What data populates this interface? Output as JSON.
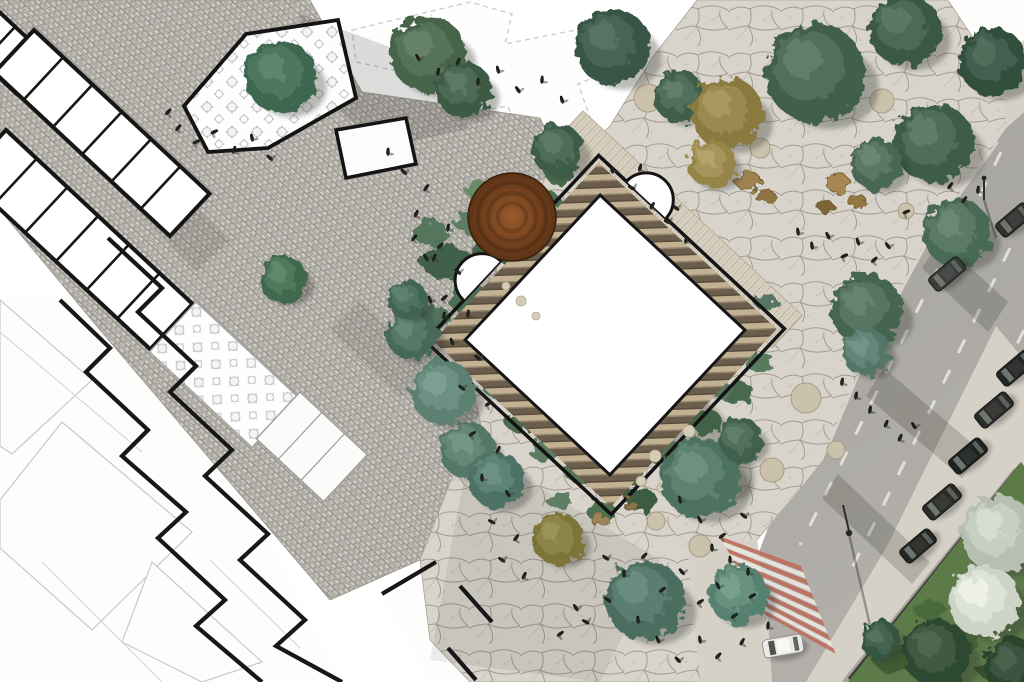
{
  "meta": {
    "kind": "landscape-site-plan-rendering",
    "canvas_w": 1024,
    "canvas_h": 682
  },
  "palette": {
    "paper": "#ffffff",
    "street_joint": "#8f8b85",
    "street_stone_a": "#d0cdc7",
    "street_stone_b": "#c2bfb9",
    "plaza_bg": "#d8d4cc",
    "plaza_crack": "#a39c8f",
    "plaza_crack_lt": "#beb8ab",
    "road_a": "#a5a3a0",
    "road_b": "#b3b0aa",
    "lane_dash": "#e7e4dd",
    "curb": "#d9d6cf",
    "sidewalk": "#d5d1c7",
    "wall": "#403f39",
    "grass": "#5d7a49",
    "crosswalk_red": "#bd6e5e",
    "crosswalk_white": "#e9e6df",
    "building_stroke": "#161616",
    "faint_stroke": "#cdcdca",
    "deck": "#d7cfc0",
    "deck_line": "#a59b87",
    "scallop_light": "#c3b193",
    "scallop_dark": "#6b5d4b",
    "scallop_mid": "#93836b",
    "rust_hi": "#9a5a2c",
    "rust_lo": "#5c3316",
    "stone_seat": "#cbc2ac",
    "stone_seat_edge": "#a79d85",
    "person": "#20231e",
    "person_shadow": "#41443c",
    "shadow": "#26281f"
  },
  "scene": {
    "faint": {
      "white_fills": [
        "108,238 342,682 262,682 60,300",
        "60,300 262,682 0,682 0,300",
        "382,594 436,562 500,640 480,682 430,682"
      ],
      "dashed_poly": "352,30 470,2 512,14 505,44 596,26 612,70 578,84 594,128 520,146 508,106 432,120 420,76 356,62",
      "polys": [
        "0,300 92,380 12,454 0,446",
        "62,422 192,532 92,630 0,548 0,500",
        "152,562 262,662 202,682 122,642"
      ],
      "lines": [
        [
          0,
          332,
          142,
          452
        ],
        [
          42,
          562,
          162,
          682
        ],
        [
          210,
          560,
          300,
          648
        ],
        [
          612,
          10,
          680,
          95
        ]
      ]
    },
    "street": {
      "poly": "40,0 310,0 362,92 540,118 565,168 480,210 515,335 468,360 485,445 455,470 420,560 330,600 100,330 0,210 0,0",
      "shadows": [
        {
          "pts": "300,14 420,58 470,128 382,148 302,78",
          "o": 0.16
        },
        {
          "pts": "140,150 230,240 196,272 108,180",
          "o": 0.12
        },
        {
          "pts": "360,300 430,370 400,398 330,330",
          "o": 0.1
        }
      ]
    },
    "plaza": {
      "poly": "652,58 697,0 948,0 1012,96 1006,132 937,228 868,352 823,462 757,540 742,566 738,682 470,682 430,640 420,560 455,470 485,445 468,360 515,335 480,210 565,168 610,126",
      "white_wedge": "948,0 1024,0 1024,34 1002,58",
      "shades": [
        {
          "pts": "470,445 660,560 600,682 430,660",
          "o": 0.07
        }
      ]
    },
    "road": {
      "poly": "1006,128 1024,112 1024,520 905,682 756,682 750,620 756,560 768,528 823,460 868,352 937,228",
      "dashes": [
        "968,208 900,345 838,470 800,545",
        "1010,248 940,390 876,520 846,580",
        "1024,330 965,450 918,548",
        "1001,152 972,212"
      ],
      "edge_line": "998,142 935,228 868,352 826,452",
      "sidewalks": [
        "1024,360 1024,682 806,682 886,548 996,326",
        "688,556 757,538 768,614 772,682 700,682",
        "1003,58 1024,40 1024,112 1006,128"
      ],
      "wall": {
        "x1": 1021,
        "y1": 464,
        "x2": 849,
        "y2": 679
      },
      "grass_poly": "1021,462 1024,466 1024,682 848,682",
      "grass_blobs": [
        [
          900,
          660,
          26,
          14,
          "#3f5c33"
        ],
        [
          960,
          640,
          20,
          12,
          "#46643a"
        ],
        [
          1000,
          670,
          22,
          12,
          "#37512e"
        ],
        [
          930,
          610,
          16,
          10,
          "#4a6a3e"
        ]
      ],
      "shadows": [
        "940,240 1008,302 988,332 922,268",
        "884,368 982,452 962,478 866,396",
        "838,474 930,562 912,584 822,498"
      ],
      "crosswalk": {
        "a1": [
          719,
          536
        ],
        "a2": [
          766,
          616
        ],
        "b1": [
          801,
          566
        ],
        "b2": [
          836,
          655
        ],
        "n": 13
      },
      "poles": [
        {
          "line": [
            849,
            531,
            843,
            505
          ],
          "head": [
            849,
            533,
            3.2
          ],
          "shadow": [
            849,
            534,
            872,
            634
          ]
        },
        {
          "line": [
            984,
            178,
            984,
            200
          ],
          "head": [
            984,
            178,
            2.4
          ],
          "shadow": [
            984,
            200,
            996,
            238
          ]
        }
      ]
    },
    "buildings": {
      "rows": [
        {
          "t": [
            -20,
            -6
          ],
          "rot": 43,
          "w": 95,
          "h": 48,
          "divs": [
            48
          ]
        },
        {
          "t": [
            34,
            30
          ],
          "rot": 43,
          "w": 240,
          "h": 58,
          "divs": [
            40,
            80,
            120,
            160,
            200
          ]
        },
        {
          "t": [
            6,
            130
          ],
          "rot": 43,
          "w": 255,
          "h": 62,
          "divs": [
            42,
            84,
            126,
            168,
            210
          ]
        }
      ],
      "table_rooms": [
        {
          "poly": "184,106 246,34 338,20 356,98 268,148 208,152",
          "stroke": "#141414",
          "sw": 3.8,
          "fill": "url(#patTables)"
        },
        {
          "t": [
            196,
            302
          ],
          "rot": 43,
          "w": 140,
          "h": 68,
          "stroke": "#a7a7a5",
          "sw": 1.4,
          "fill": "url(#patTables)"
        },
        {
          "t": [
            300,
            392
          ],
          "rot": 43,
          "w": 92,
          "h": 64,
          "stroke": "#9c9c9a",
          "sw": 1.4,
          "fill": "#fbfbfa",
          "divs": [
            30,
            61
          ]
        }
      ],
      "block": {
        "poly": "336,130 406,118 416,164 346,178",
        "stroke": "#141414",
        "sw": 3.5,
        "fill": "#fcfcfc"
      },
      "zigzags": [
        "M108,238 L162,288 L138,312 L196,366 L170,392 L232,450 L205,476 L268,534 L240,560 L305,620 L276,646 L342,682",
        "M60,300 L110,348 L86,372 L148,430 L122,456 L186,512 L158,538 L225,600 L196,626 L262,682",
        "M382,594 L436,562",
        "M460,586 L492,622",
        "M448,648 L476,680"
      ]
    },
    "pavilion": {
      "cx": 605,
      "cy": 335,
      "rot": 43,
      "deck": [
        436,
        186,
        300,
        44
      ],
      "outer": [
        478,
        208,
        254,
        254
      ],
      "band": [
        494,
        224,
        222,
        222
      ],
      "band_w": 21,
      "inner": [
        506,
        236,
        198,
        198
      ],
      "arcs": [
        "M516,208 A27,27 0 0 1 570,208",
        "M478,352 A27,27 0 0 0 478,406"
      ],
      "under_shadow": {
        "cx": 680,
        "cy": 430,
        "rx": 95,
        "ry": 40
      }
    },
    "rust_circle": {
      "cx": 512,
      "cy": 217,
      "r": 44
    },
    "garden_blobs": [
      [
        447,
        262,
        26,
        17,
        "#3f6149"
      ],
      [
        469,
        299,
        21,
        15,
        "#4a6e54"
      ],
      [
        431,
        233,
        17,
        13,
        "#55755c"
      ],
      [
        491,
        251,
        19,
        13,
        "#43634b"
      ],
      [
        543,
        201,
        17,
        11,
        "#4c6d52"
      ],
      [
        470,
        223,
        15,
        11,
        "#5c7d63"
      ],
      [
        499,
        299,
        17,
        11,
        "#57806b"
      ],
      [
        432,
        318,
        19,
        13,
        "#507258"
      ],
      [
        560,
        176,
        14,
        9,
        "#48684e"
      ],
      [
        588,
        190,
        13,
        8,
        "#3f5c46"
      ],
      [
        478,
        190,
        13,
        9,
        "#6b8b6b"
      ],
      [
        516,
        262,
        14,
        9,
        "#35573f"
      ],
      [
        744,
        330,
        19,
        13,
        "#4b6b51"
      ],
      [
        760,
        362,
        15,
        10,
        "#5a7a60"
      ],
      [
        737,
        392,
        17,
        11,
        "#49694f"
      ],
      [
        764,
        300,
        12,
        8,
        "#567564"
      ],
      [
        701,
        421,
        21,
        13,
        "#426247"
      ],
      [
        662,
        451,
        19,
        12,
        "#507053"
      ],
      [
        622,
        472,
        21,
        13,
        "#45654a"
      ],
      [
        582,
        471,
        19,
        12,
        "#527257"
      ],
      [
        546,
        451,
        17,
        11,
        "#5b7b60"
      ],
      [
        521,
        421,
        17,
        11,
        "#4b6b50"
      ],
      [
        501,
        391,
        15,
        10,
        "#567666"
      ],
      [
        641,
        500,
        17,
        11,
        "#3d5d42"
      ],
      [
        601,
        511,
        15,
        10,
        "#507050"
      ],
      [
        560,
        500,
        14,
        9,
        "#5e7e63"
      ],
      [
        472,
        346,
        17,
        11,
        "#486850"
      ],
      [
        694,
        455,
        14,
        9,
        "#6f8f5e"
      ],
      [
        720,
        390,
        13,
        9,
        "#587860"
      ],
      [
        652,
        435,
        10,
        6,
        "#8aa878"
      ],
      [
        608,
        455,
        9,
        5,
        "#93ad7f"
      ],
      [
        532,
        390,
        9,
        5,
        "#7fa06f"
      ],
      [
        488,
        300,
        8,
        5,
        "#96ae82"
      ],
      [
        705,
        365,
        8,
        5,
        "#88a476"
      ]
    ],
    "rocks": [
      [
        748,
        181,
        13,
        9,
        "#a08350"
      ],
      [
        766,
        197,
        10,
        7,
        "#8f7342"
      ],
      [
        838,
        183,
        12,
        9,
        "#a5874f"
      ],
      [
        857,
        201,
        9,
        7,
        "#93763f"
      ],
      [
        826,
        207,
        8,
        6,
        "#7d6438"
      ],
      [
        600,
        520,
        9,
        6,
        "#9b8458"
      ],
      [
        630,
        505,
        7,
        5,
        "#8a7348"
      ]
    ],
    "stones": [
      [
        648,
        98,
        14
      ],
      [
        760,
        148,
        10
      ],
      [
        882,
        101,
        12
      ],
      [
        941,
        138,
        12
      ],
      [
        806,
        398,
        15
      ],
      [
        772,
        470,
        12
      ],
      [
        700,
        546,
        11
      ],
      [
        656,
        521,
        9
      ],
      [
        906,
        211,
        8
      ],
      [
        836,
        450,
        9
      ]
    ],
    "stepping_stones": [
      [
        655,
        456,
        6
      ],
      [
        671,
        470,
        5
      ],
      [
        641,
        481,
        5
      ],
      [
        521,
        301,
        5
      ],
      [
        506,
        286,
        4
      ],
      [
        536,
        316,
        4
      ],
      [
        689,
        431,
        6
      ],
      [
        662,
        488,
        5
      ]
    ],
    "trees": [
      [
        281,
        77,
        36,
        "#3e6750"
      ],
      [
        283,
        279,
        24,
        "#40684e"
      ],
      [
        412,
        334,
        26,
        "#47695a"
      ],
      [
        408,
        300,
        20,
        "#3f6352"
      ],
      [
        443,
        392,
        32,
        "#5c8173"
      ],
      [
        467,
        450,
        28,
        "#547767"
      ],
      [
        497,
        480,
        28,
        "#4e7265"
      ],
      [
        645,
        600,
        40,
        "#4b6e60"
      ],
      [
        700,
        478,
        40,
        "#4e7260"
      ],
      [
        738,
        594,
        30,
        "#57806f"
      ],
      [
        741,
        440,
        22,
        "#405f4d"
      ],
      [
        558,
        539,
        26,
        "#7d7437"
      ],
      [
        558,
        150,
        26,
        "#3c5c49"
      ],
      [
        428,
        54,
        38,
        "#466349"
      ],
      [
        464,
        90,
        28,
        "#3c5a45"
      ],
      [
        613,
        47,
        38,
        "#375444"
      ],
      [
        680,
        97,
        26,
        "#415f4c"
      ],
      [
        727,
        113,
        36,
        "#8a7a40"
      ],
      [
        712,
        164,
        24,
        "#96854a"
      ],
      [
        815,
        73,
        50,
        "#435f4b"
      ],
      [
        905,
        30,
        36,
        "#3b5947"
      ],
      [
        993,
        62,
        34,
        "#334f3e"
      ],
      [
        934,
        143,
        40,
        "#3e5d4a"
      ],
      [
        876,
        164,
        26,
        "#4a6853"
      ],
      [
        957,
        233,
        34,
        "#4a6a55"
      ],
      [
        867,
        310,
        36,
        "#45654f"
      ],
      [
        866,
        352,
        24,
        "#527668"
      ],
      [
        999,
        534,
        38,
        "#b7bfb2"
      ],
      [
        984,
        601,
        36,
        "#ced3c8"
      ],
      [
        937,
        653,
        34,
        "#2e4832"
      ],
      [
        1012,
        666,
        28,
        "#2a442e"
      ],
      [
        880,
        640,
        20,
        "#365540"
      ]
    ],
    "cars": [
      [
        947,
        274,
        -40,
        38,
        17,
        "#3a3d3a"
      ],
      [
        1014,
        220,
        -40,
        38,
        17,
        "#2f322f"
      ],
      [
        1016,
        368,
        -40,
        40,
        18,
        "#232623"
      ],
      [
        994,
        410,
        -40,
        40,
        18,
        "#2a2d2a"
      ],
      [
        968,
        456,
        -40,
        40,
        18,
        "#1f231f"
      ],
      [
        942,
        502,
        -40,
        40,
        18,
        "#2a2c28"
      ],
      [
        918,
        546,
        -40,
        38,
        17,
        "#242722"
      ],
      [
        783,
        646,
        -10,
        40,
        18,
        "#eceae6"
      ]
    ],
    "people": [
      [
        178,
        128
      ],
      [
        196,
        142
      ],
      [
        214,
        132
      ],
      [
        234,
        150
      ],
      [
        252,
        138
      ],
      [
        270,
        158
      ],
      [
        168,
        112
      ],
      [
        388,
        152
      ],
      [
        404,
        172
      ],
      [
        426,
        188
      ],
      [
        416,
        214
      ],
      [
        448,
        228
      ],
      [
        434,
        258
      ],
      [
        458,
        272
      ],
      [
        444,
        298
      ],
      [
        468,
        314
      ],
      [
        452,
        342
      ],
      [
        478,
        358
      ],
      [
        462,
        388
      ],
      [
        488,
        404
      ],
      [
        472,
        434
      ],
      [
        498,
        450
      ],
      [
        482,
        478
      ],
      [
        508,
        494
      ],
      [
        492,
        522
      ],
      [
        516,
        538
      ],
      [
        502,
        560
      ],
      [
        524,
        576
      ],
      [
        418,
        58
      ],
      [
        438,
        72
      ],
      [
        458,
        62
      ],
      [
        478,
        82
      ],
      [
        498,
        70
      ],
      [
        518,
        90
      ],
      [
        542,
        80
      ],
      [
        562,
        100
      ],
      [
        612,
        170
      ],
      [
        632,
        188
      ],
      [
        652,
        206
      ],
      [
        640,
        168
      ],
      [
        668,
        222
      ],
      [
        686,
        240
      ],
      [
        676,
        208
      ],
      [
        414,
        238
      ],
      [
        426,
        258
      ],
      [
        440,
        246
      ],
      [
        430,
        300
      ],
      [
        444,
        316
      ],
      [
        798,
        232
      ],
      [
        812,
        246
      ],
      [
        828,
        236
      ],
      [
        844,
        256
      ],
      [
        858,
        242
      ],
      [
        874,
        260
      ],
      [
        888,
        246
      ],
      [
        950,
        186
      ],
      [
        964,
        200
      ],
      [
        978,
        190
      ],
      [
        906,
        212
      ],
      [
        856,
        396
      ],
      [
        870,
        410
      ],
      [
        886,
        424
      ],
      [
        900,
        438
      ],
      [
        914,
        426
      ],
      [
        842,
        382
      ],
      [
        606,
        558
      ],
      [
        624,
        574
      ],
      [
        644,
        556
      ],
      [
        662,
        590
      ],
      [
        682,
        572
      ],
      [
        700,
        602
      ],
      [
        718,
        586
      ],
      [
        734,
        616
      ],
      [
        752,
        596
      ],
      [
        768,
        626
      ],
      [
        700,
        640
      ],
      [
        718,
        656
      ],
      [
        742,
        642
      ],
      [
        638,
        620
      ],
      [
        658,
        640
      ],
      [
        678,
        660
      ],
      [
        608,
        600
      ],
      [
        586,
        622
      ],
      [
        576,
        608
      ],
      [
        560,
        634
      ],
      [
        700,
        520
      ],
      [
        722,
        536
      ],
      [
        744,
        516
      ],
      [
        680,
        500
      ],
      [
        730,
        560
      ],
      [
        748,
        572
      ],
      [
        712,
        548
      ]
    ]
  }
}
